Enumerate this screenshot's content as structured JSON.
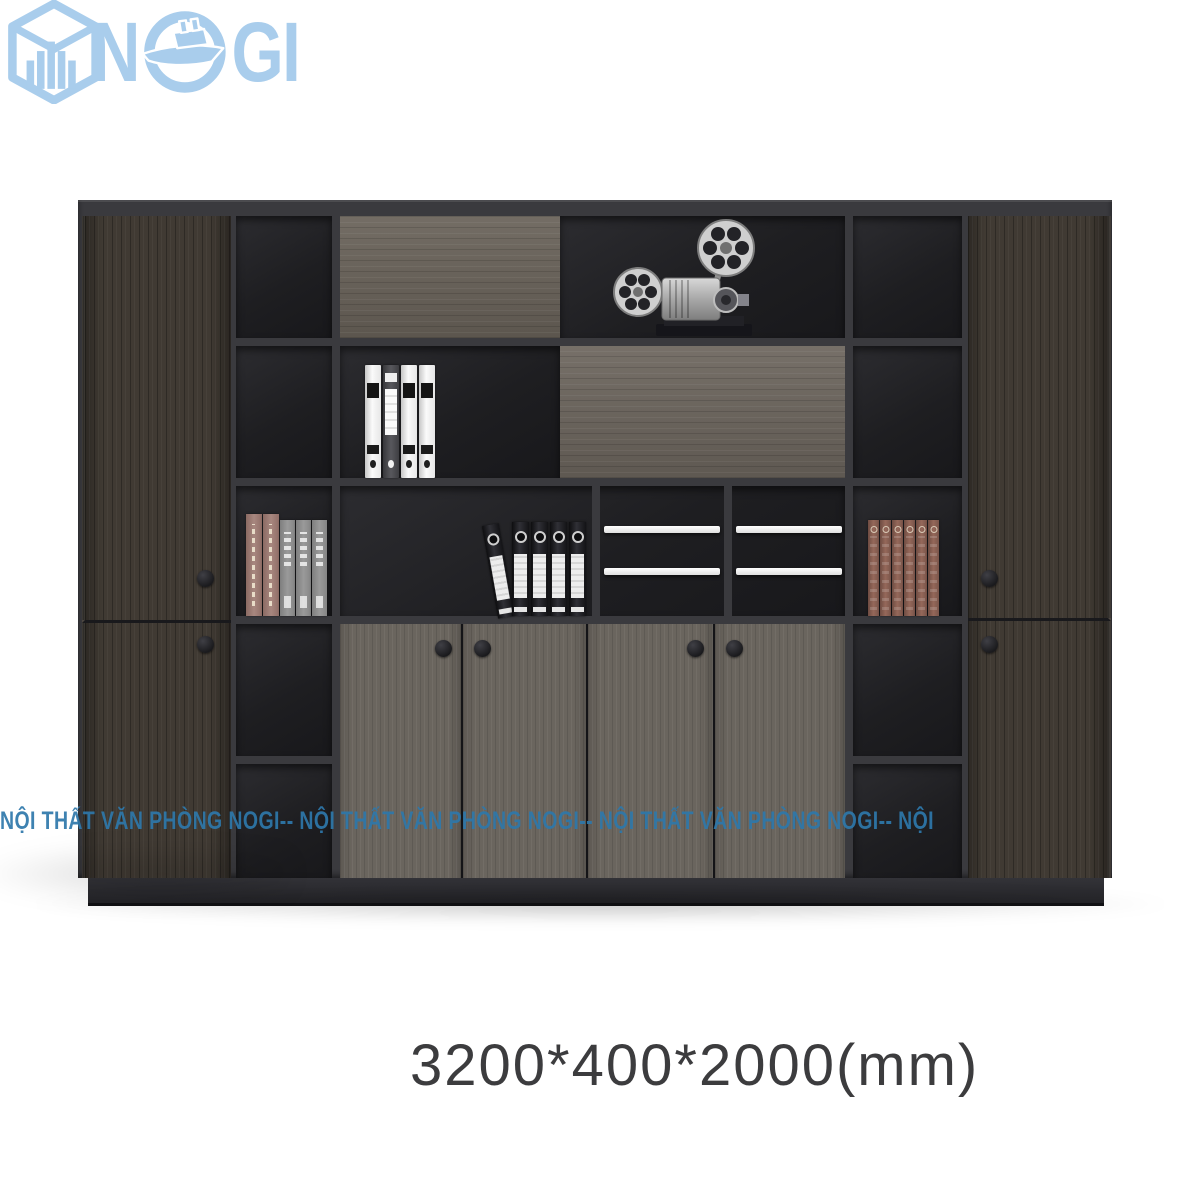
{
  "brand": {
    "name": "NOGI",
    "text_n": "N",
    "text_gi": "GI",
    "color": "#a9cdec",
    "icons": [
      "hexagon-building-icon",
      "ship-icon"
    ]
  },
  "watermark": {
    "text": "NỘI THẤT VĂN PHÒNG NOGI-- NỘI THẤT VĂN PHÒNG NOGI-- NỘI THẤT VĂN PHÒNG NOGI-- NỘI THẤT VĂN PHÒNG NOGI",
    "color": "#2e78ab"
  },
  "caption": {
    "dimensions": "3200*400*2000(mm)",
    "color": "#3c3c3e"
  },
  "cabinet": {
    "frame_color": "#3a3a3e",
    "back_color": "#1f1f22",
    "outer_wood_color": "#403a33",
    "panel_wood_color": "#6b645b",
    "door_wood_color": "#6a655e",
    "plinth_color": "#2b2b2e",
    "objects": [
      "film-projector",
      "white-binders",
      "black-binders",
      "pink-gray-books",
      "red-books",
      "display-rails"
    ]
  }
}
